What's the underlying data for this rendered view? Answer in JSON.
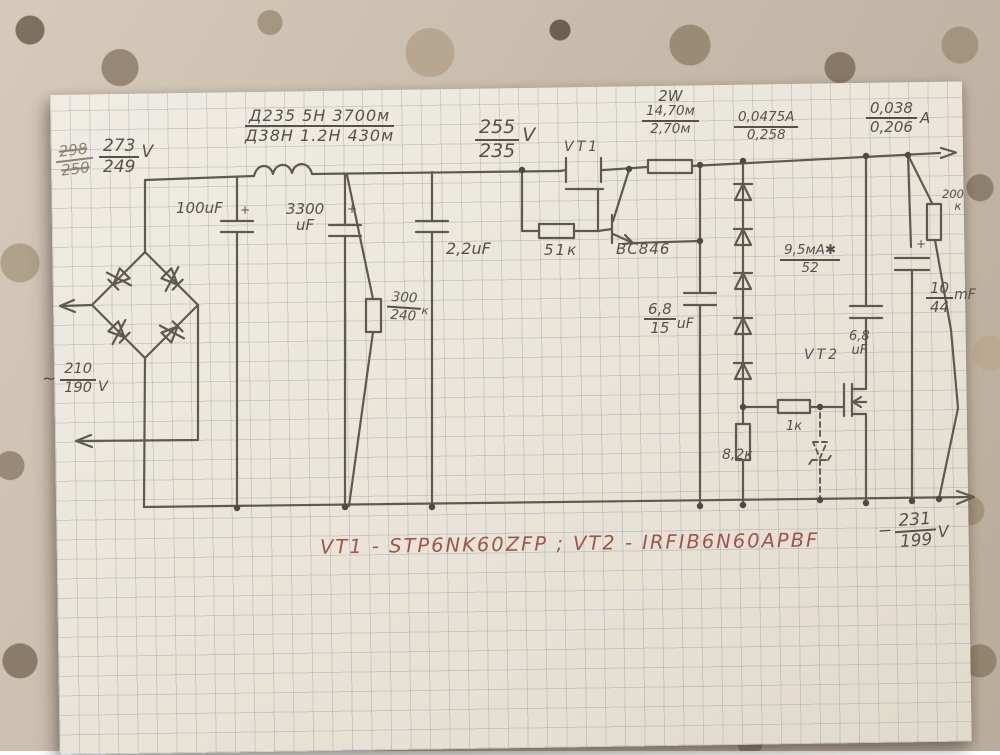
{
  "labels": {
    "v_bridge_old": {
      "num": "298",
      "den": "250"
    },
    "v_bridge": {
      "num": "273",
      "den": "249",
      "unit": "V"
    },
    "c1": {
      "value": "100uF",
      "plus": "+"
    },
    "l1": {
      "num": "Д235 5Н 3700м",
      "den": "Д38Н 1.2Н 430м"
    },
    "c2": {
      "line1": "3300",
      "line2": "uF",
      "plus": "+"
    },
    "r1": {
      "num": "300",
      "den": "240",
      "suffix": "к"
    },
    "c3": {
      "value": "2,2uF"
    },
    "v_reg": {
      "num": "255",
      "den": "235",
      "unit": "V"
    },
    "vt1": {
      "name": "VT1"
    },
    "r2": {
      "value": "51к"
    },
    "q1": {
      "value": "BC846"
    },
    "r3": {
      "power": "2W",
      "num": "14,70м",
      "den": "2,70м"
    },
    "i1": {
      "num": "0,0475A",
      "den": "0,258"
    },
    "i2": {
      "num": "0,038",
      "den": "0,206",
      "unit": "A"
    },
    "c4": {
      "num": "6,8",
      "den": "15",
      "unit": "uF"
    },
    "i3": {
      "num": "9,5мА✱",
      "den": "52"
    },
    "r4": {
      "value": "8,2к"
    },
    "r5": {
      "value": "1к"
    },
    "vt2": {
      "name": "VT2"
    },
    "c5": {
      "line1": "6,8",
      "line2": "uF"
    },
    "r6": {
      "line1": "200",
      "line2": "к"
    },
    "c6": {
      "num": "10",
      "den": "44",
      "unit": "mF",
      "plus": "+"
    },
    "v_out": {
      "minus": "−",
      "num": "231",
      "den": "199",
      "unit": "V"
    },
    "ac": {
      "tilde": "~",
      "num": "210",
      "den": "190",
      "unit": "V"
    }
  },
  "caption": {
    "text": "VT1 - STP6NK60ZFP ; VT2 - IRFIB6N60APBF"
  }
}
